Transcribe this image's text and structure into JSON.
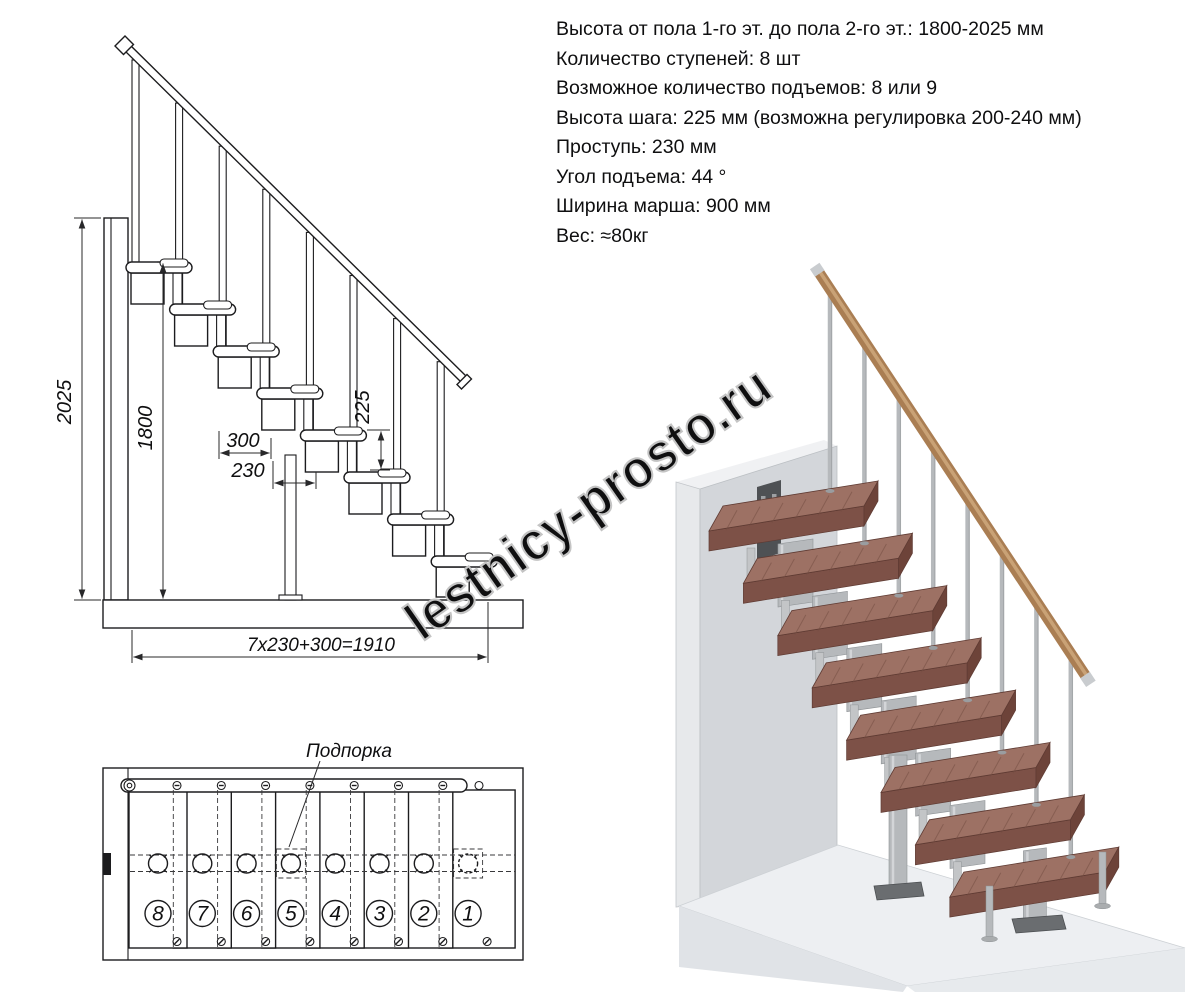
{
  "specs": {
    "lines": [
      "Высота от пола 1-го эт. до пола 2-го эт.: 1800-2025 мм",
      "Количество ступеней: 8 шт",
      "Возможное количество подъемов: 8 или 9",
      "Высота шага: 225 мм (возможна регулировка 200-240 мм)",
      "Проступь: 230 мм",
      "Угол подъема: 44 °",
      "Ширина марша: 900 мм",
      "Вес: ≈80кг"
    ]
  },
  "side_view": {
    "steps_count": 8,
    "dim_height_total": "2025",
    "dim_height_floor": "1800",
    "dim_rise": "225",
    "dim_platform_depth": "300",
    "dim_tread_depth": "230",
    "dim_total_run": "7x230+300=1910"
  },
  "plan_view": {
    "support_label": "Подпорка",
    "step_numbers": [
      "8",
      "7",
      "6",
      "5",
      "4",
      "3",
      "2",
      "1"
    ]
  },
  "watermark": "lestnicy-prosto.ru",
  "colors": {
    "line": "#1c1c1e",
    "wood_top": "#9d7164",
    "wood_front": "#7d5147",
    "wood_side": "#6d4339",
    "wood_grain": "#754e43",
    "wood_edge": "#5f3b33",
    "metal": "#b6b9bc",
    "metal_light": "#d9dbdd",
    "metal_dark": "#8f9396",
    "rail_wood": "#aa7e53",
    "rail_wood_light": "#cda67a",
    "cap_silver": "#c9cccf",
    "wall_front": "#d3d6da",
    "wall_side": "#e7e9eb",
    "wall_top": "#f0f1f3",
    "wall_shadow": "#c6cacd",
    "floor_top": "#edeff2",
    "floor_front": "#e0e3e7",
    "floor_right": "#e7eaed",
    "plate_dark": "#4e5154",
    "plate_hole": "#9da0a3",
    "flange": "#6a6d70",
    "watermark_gray": "#c4c4c4"
  }
}
